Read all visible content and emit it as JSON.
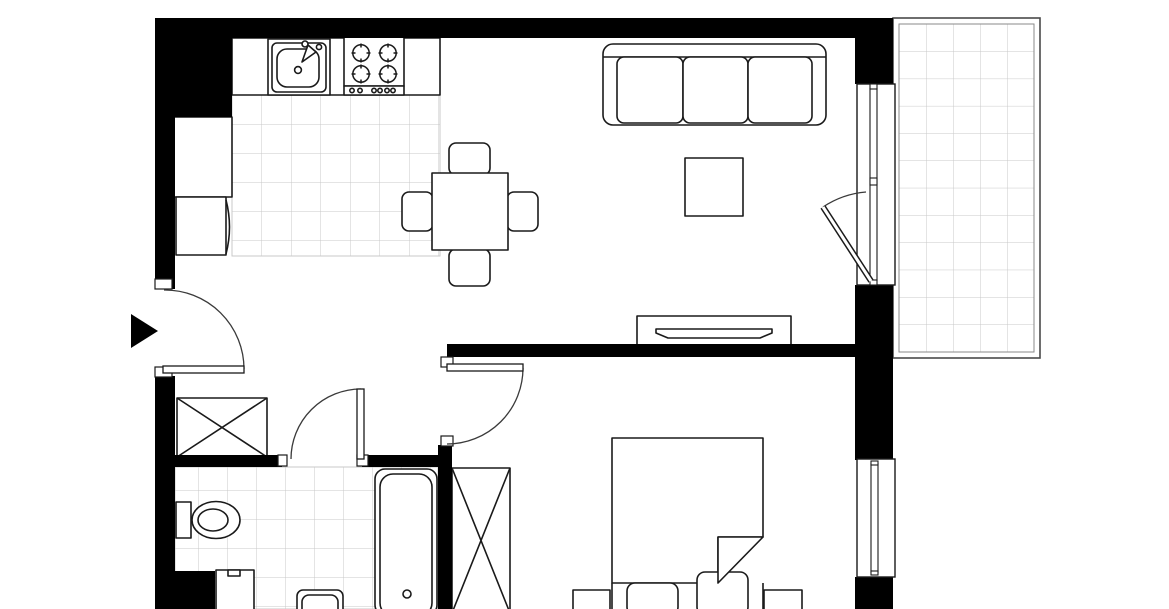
{
  "title": "apartment floor plan",
  "colors": {
    "background": "#ffffff",
    "wall": "#000000",
    "outline": "#1a1a1a",
    "tile_grid": "#c9c9c9",
    "door_arc": "#3a3a3a",
    "frame": "#8a8a8a"
  },
  "labels": {
    "plan": "one-bedroom apartment floor plan with balcony",
    "kitchen_sink": "kitchen sink",
    "stove": "four-burner stove",
    "refrigerator": "refrigerator cabinet",
    "dining_table": "dining table with four chairs",
    "sofa": "three-seat sofa",
    "coffee_table": "coffee table",
    "tv_stand": "tv stand with television",
    "balcony": "tiled balcony",
    "hall_wardrobe": "hallway wardrobe",
    "bedroom_wardrobe": "bedroom wardrobe",
    "toilet": "toilet",
    "washing_machine": "washing machine",
    "washbasin": "washbasin",
    "bathtub": "bathtub",
    "bed": "double bed with pillows and folded blanket",
    "nightstand_left": "left nightstand",
    "nightstand_right": "right nightstand",
    "entrance_door": "entrance door swing",
    "bathroom_door": "bathroom door swing",
    "bedroom_door": "bedroom door swing",
    "balcony_door": "balcony door swing",
    "balcony_window": "balcony door window",
    "bedroom_window": "bedroom window",
    "entrance_arrow": "entrance direction marker",
    "walls": "load-bearing and partition walls",
    "kitchen_floor": "kitchen tiled floor",
    "bathroom_floor": "bathroom tiled floor"
  }
}
